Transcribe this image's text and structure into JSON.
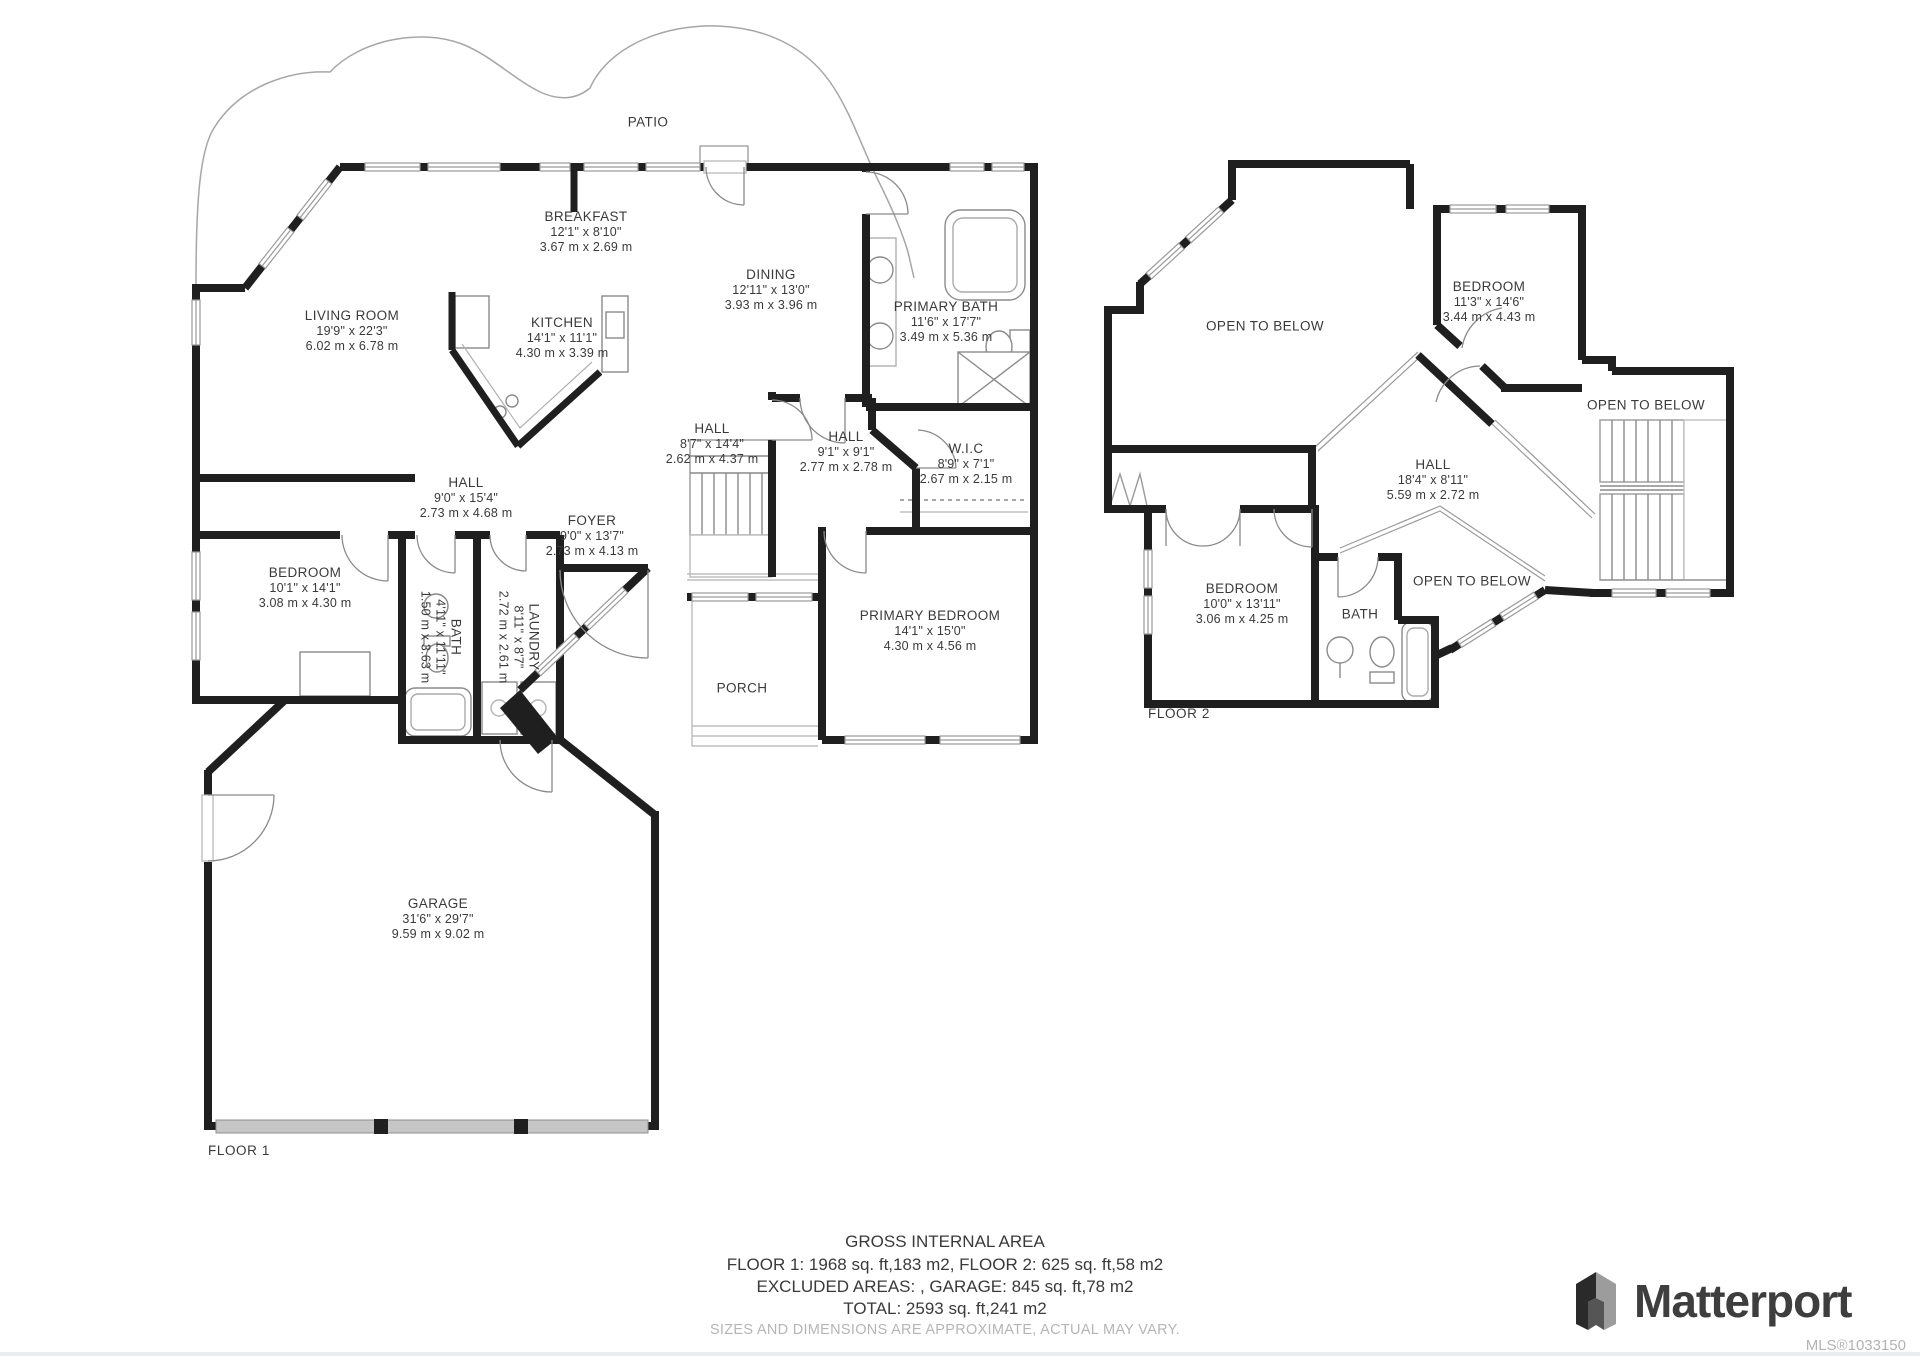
{
  "colors": {
    "wall": "#1f1f1f",
    "thin_line": "#9a9a9a",
    "text": "#3a3a3a",
    "muted_text": "#b3b3b3",
    "garage_door": "#c6c6c6"
  },
  "floor1": {
    "label": "FLOOR 1",
    "rooms": [
      {
        "id": "patio",
        "name": "PATIO"
      },
      {
        "id": "breakfast",
        "name": "BREAKFAST",
        "ft": "12'1\" x 8'10\"",
        "m": "3.67 m x 2.69 m"
      },
      {
        "id": "living-room",
        "name": "LIVING ROOM",
        "ft": "19'9\" x 22'3\"",
        "m": "6.02 m x 6.78 m"
      },
      {
        "id": "kitchen",
        "name": "KITCHEN",
        "ft": "14'1\" x 11'1\"",
        "m": "4.30 m x 3.39 m"
      },
      {
        "id": "dining",
        "name": "DINING",
        "ft": "12'11\" x 13'0\"",
        "m": "3.93 m x 3.96 m"
      },
      {
        "id": "primary-bath",
        "name": "PRIMARY BATH",
        "ft": "11'6\" x 17'7\"",
        "m": "3.49 m x 5.36 m"
      },
      {
        "id": "hall-upper",
        "name": "HALL",
        "ft": "8'7\" x 14'4\"",
        "m": "2.62 m x 4.37 m"
      },
      {
        "id": "hall-mid",
        "name": "HALL",
        "ft": "9'1\" x 9'1\"",
        "m": "2.77 m x 2.78 m"
      },
      {
        "id": "wic",
        "name": "W.I.C",
        "ft": "8'9\" x 7'1\"",
        "m": "2.67 m x 2.15 m"
      },
      {
        "id": "hall-lower",
        "name": "HALL",
        "ft": "9'0\" x 15'4\"",
        "m": "2.73 m x 4.68 m"
      },
      {
        "id": "foyer",
        "name": "FOYER",
        "ft": "9'0\" x 13'7\"",
        "m": "2.73 m x 4.13 m"
      },
      {
        "id": "bedroom",
        "name": "BEDROOM",
        "ft": "10'1\" x 14'1\"",
        "m": "3.08 m x 4.30 m"
      },
      {
        "id": "bath",
        "name": "BATH",
        "ft": "4'11\" x 11'11\"",
        "m": "1.50 m x 3.63 m"
      },
      {
        "id": "laundry",
        "name": "LAUNDRY",
        "ft": "8'11\" x 8'7\"",
        "m": "2.72 m x 2.61 m"
      },
      {
        "id": "porch",
        "name": "PORCH"
      },
      {
        "id": "primary-bedroom",
        "name": "PRIMARY BEDROOM",
        "ft": "14'1\" x 15'0\"",
        "m": "4.30 m x 4.56 m"
      },
      {
        "id": "garage",
        "name": "GARAGE",
        "ft": "31'6\" x 29'7\"",
        "m": "9.59 m x 9.02 m"
      }
    ]
  },
  "floor2": {
    "label": "FLOOR 2",
    "rooms": [
      {
        "id": "open-left",
        "name": "OPEN TO BELOW"
      },
      {
        "id": "bedroom-upper",
        "name": "BEDROOM",
        "ft": "11'3\" x 14'6\"",
        "m": "3.44 m x 4.43 m"
      },
      {
        "id": "open-right",
        "name": "OPEN TO BELOW"
      },
      {
        "id": "hall",
        "name": "HALL",
        "ft": "18'4\" x 8'11\"",
        "m": "5.59 m x 2.72 m"
      },
      {
        "id": "open-bottom",
        "name": "OPEN TO BELOW"
      },
      {
        "id": "bedroom-lower",
        "name": "BEDROOM",
        "ft": "10'0\" x 13'11\"",
        "m": "3.06 m x 4.25 m"
      },
      {
        "id": "bath",
        "name": "BATH"
      }
    ]
  },
  "footer": {
    "title": "GROSS INTERNAL AREA",
    "line1": "FLOOR 1: 1968 sq. ft,183 m2, FLOOR 2: 625 sq. ft,58 m2",
    "line2": "EXCLUDED AREAS: , GARAGE: 845 sq. ft,78 m2",
    "line3": "TOTAL: 2593 sq. ft,241 m2",
    "disclaimer": "SIZES AND DIMENSIONS ARE APPROXIMATE, ACTUAL MAY VARY."
  },
  "brand": {
    "name": "Matterport",
    "mls": "MLS®1033150"
  }
}
